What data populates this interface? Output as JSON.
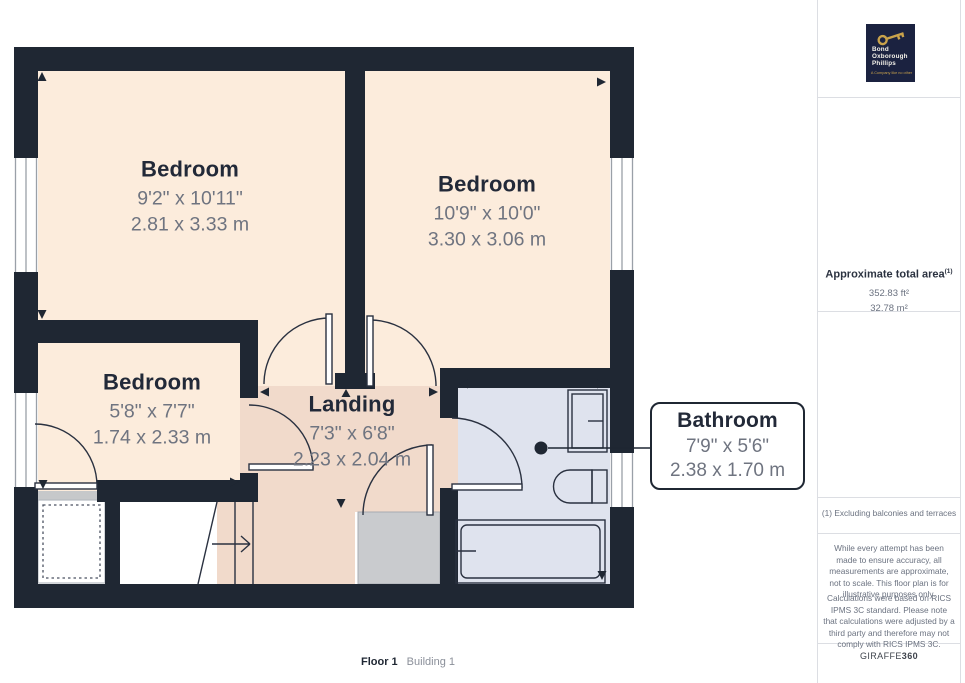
{
  "plan": {
    "rooms": [
      {
        "id": "bedroom-1",
        "name": "Bedroom",
        "imperial": "9'2\" x 10'11\"",
        "metric": "2.81 x 3.33 m"
      },
      {
        "id": "bedroom-2",
        "name": "Bedroom",
        "imperial": "10'9\" x 10'0\"",
        "metric": "3.30 x 3.06 m"
      },
      {
        "id": "bedroom-3",
        "name": "Bedroom",
        "imperial": "5'8\" x 7'7\"",
        "metric": "1.74 x 2.33 m"
      },
      {
        "id": "landing",
        "name": "Landing",
        "imperial": "7'3\" x 6'8\"",
        "metric": "2.23 x 2.04 m"
      },
      {
        "id": "bathroom",
        "name": "Bathroom",
        "imperial": "7'9\" x 5'6\"",
        "metric": "2.38 x 1.70 m"
      }
    ],
    "floor_label": "Floor 1",
    "building_label": "Building 1",
    "colors": {
      "wall": "#1f2733",
      "bedroom_floor": "#fcecdc",
      "landing_floor": "#f1dacb",
      "bathroom_floor": "#dfe3ee",
      "cupboard_gray": "#c9cbce"
    }
  },
  "sidebar": {
    "logo": {
      "lines": [
        "Bond",
        "Oxborough",
        "Phillips"
      ],
      "tagline": "A Company like no other",
      "bg_color": "#1b2240",
      "key_color": "#c9a24b"
    },
    "area": {
      "title": "Approximate total area",
      "sup": "(1)",
      "imperial": "352.83 ft²",
      "metric": "32.78 m²"
    },
    "footnote": "(1) Excluding balconies and terraces",
    "disclaimer1": "While every attempt has been made to ensure accuracy, all measurements are approximate, not to scale. This floor plan is for illustrative purposes only.",
    "disclaimer2": "Calculations were based on RICS IPMS 3C standard. Please note that calculations were adjusted by a third party and therefore may not comply with RICS IPMS 3C.",
    "brand": {
      "name": "GIRAFFE",
      "suffix": "360"
    }
  }
}
